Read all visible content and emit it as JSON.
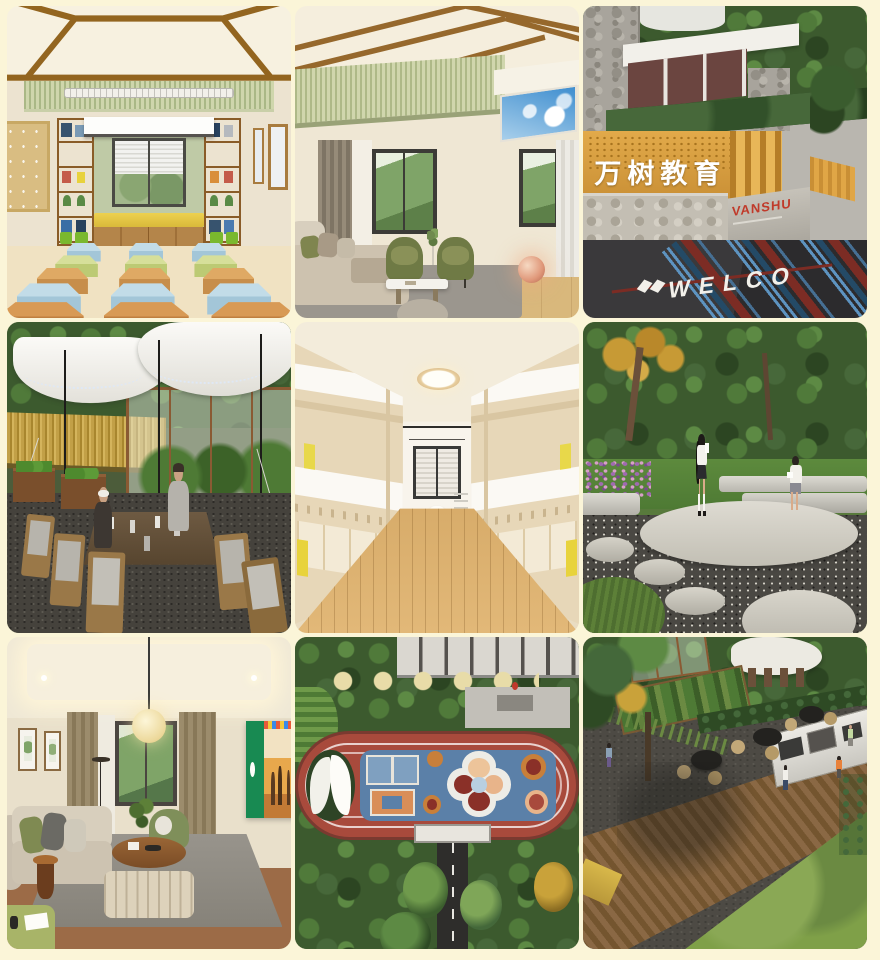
{
  "page": {
    "background": "#FBF5D8",
    "tile_radius_px": 12,
    "grid": {
      "rows": 3,
      "cols": 3
    }
  },
  "gallery": {
    "tiles": [
      {
        "key": "classroom",
        "title": "Classroom with hexagon stools and bookshelves"
      },
      {
        "key": "livingroom",
        "title": "Lounge with sky ceiling panel and green armchairs"
      },
      {
        "key": "entrance",
        "title": "Campus entrance with brand signage"
      },
      {
        "key": "tent",
        "title": "Outdoor canopy dining beside wheat field and greenhouse"
      },
      {
        "key": "dormitory",
        "title": "Wooden bunk-bed dormitory corridor"
      },
      {
        "key": "garden",
        "title": "Reading garden with round stone platform"
      },
      {
        "key": "lounge2",
        "title": "Family lounge with paper lantern lamp"
      },
      {
        "key": "playground",
        "title": "Aerial view of running track and play court"
      },
      {
        "key": "terrace",
        "title": "Aerial view of barbecue terrace and farm garden"
      }
    ]
  },
  "signage": {
    "fence_text": "万树教育",
    "brand_text": "VANSHU",
    "road_text": "WELCO"
  },
  "palette": {
    "background_cream": "#FBF5D8",
    "fence_orange": "#DDA03E",
    "brand_red": "#C03A2A",
    "track_red": "#A84A3C",
    "infield_blue": "#5B80A8",
    "stool_blue": "#A3C6D8",
    "stool_green": "#BCCA74",
    "stool_orange": "#C78E4B"
  }
}
